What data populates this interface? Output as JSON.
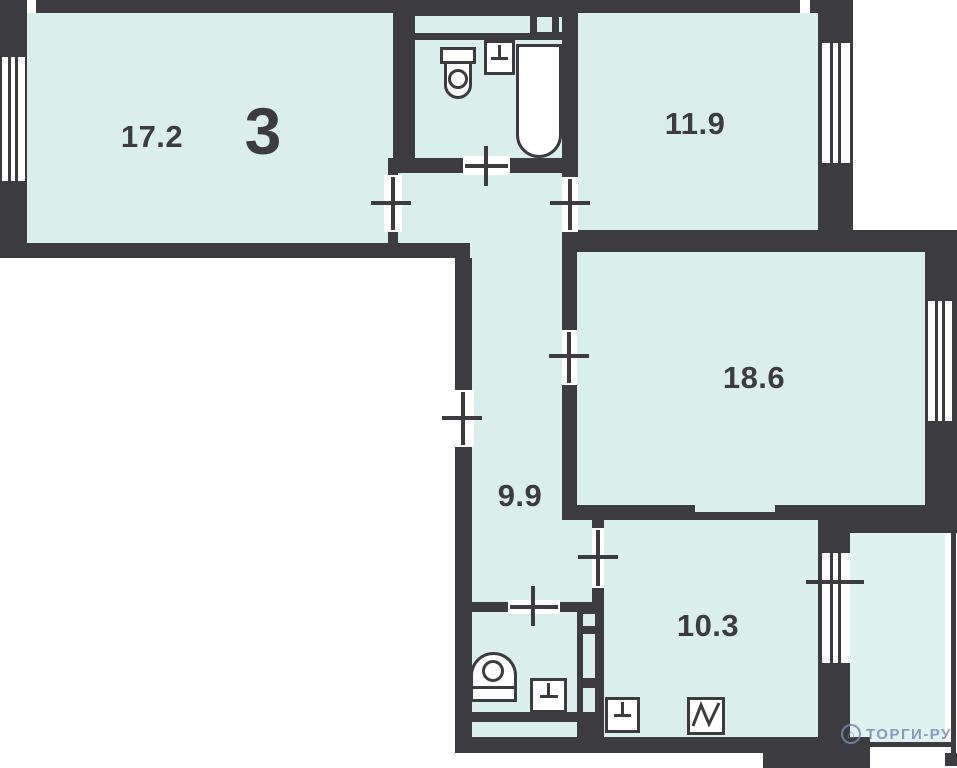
{
  "apartment": {
    "rooms_count_label": "3",
    "areas": {
      "living_large": "17.2",
      "bedroom": "11.9",
      "living_second": "18.6",
      "hallway": "9.9",
      "kitchen": "10.3"
    }
  },
  "fixtures": {
    "bathroom": [
      "toilet",
      "washbasin",
      "bathtub"
    ],
    "wc": [
      "toilet",
      "washbasin"
    ],
    "kitchen": [
      "sink",
      "stove"
    ]
  },
  "watermark": {
    "logo": "house-in-circle",
    "text": "ТОРГИ-РУ"
  },
  "colors": {
    "wall": "#3b3b40",
    "room_fill": "#d9efeb",
    "balcony_fill": "#def2ef",
    "background": "#ffffff",
    "fixture_fill": "#ffffff",
    "watermark": "#7d86b2"
  }
}
